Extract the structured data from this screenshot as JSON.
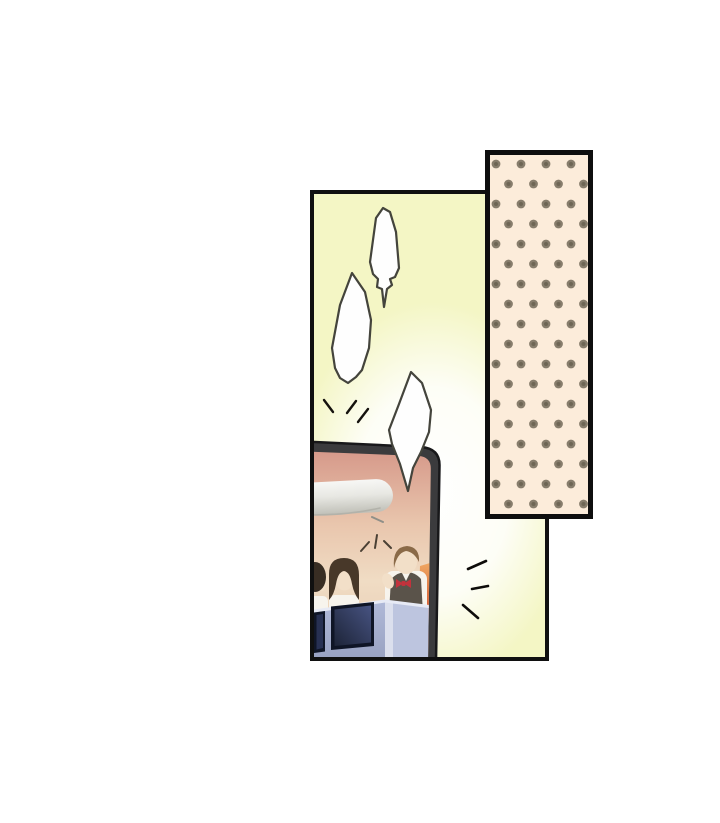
{
  "page": {
    "kind": "manga-panel-page",
    "background": "#ffffff"
  },
  "colors": {
    "page_bg": "#ffffff",
    "panel_fill": "#f4f6c5",
    "panel_border": "#101010",
    "glow_white": "#ffffff",
    "bubble_fill": "#fefefe",
    "bubble_stroke": "#44443c",
    "flutter_stroke": "#15120e",
    "emphasis_stroke": "#0e0c0a",
    "spark_stroke": "#4a4034",
    "polka_bg": "#fcecda",
    "polka_dot": "#877d6c",
    "polka_dot_core": "#6e6655",
    "polka_border": "#0e0e0e",
    "tv_frame": "#3b3b3d",
    "tv_frame_edge": "#18181a",
    "screen_top": "#d6998a",
    "screen_upper": "#e9c6ad",
    "screen_mid": "#f0dcc4",
    "screen_lower": "#e7c9ae",
    "red_top": "#efa45e",
    "red_mid": "#d65b31",
    "red_bottom": "#bf3317",
    "bar_top": "#f7f7f5",
    "bar_mid": "#e8e8e3",
    "bar_bottom": "#bfbfb7",
    "counter_front_top": "#b0b9d8",
    "counter_front_bottom": "#98a1c1",
    "counter_side": "#bdc5df",
    "counter_edge": "#e7eaf5",
    "box_outer": "#0f1526",
    "box_inner_dark": "#1d2438",
    "box_inner_light": "#475381",
    "hair_man": "#8a6a48",
    "hair_woman": "#483829",
    "hair_person": "#382d23",
    "skin": "#f2dfc8",
    "shirt": "#f7f4ed",
    "vest": "#5a534a",
    "bowtie": "#c2323c"
  },
  "scene": {
    "panel_count": 1,
    "bubble_count": 3,
    "tv_people_count": 3,
    "emphasis_mark_groups": 3
  }
}
